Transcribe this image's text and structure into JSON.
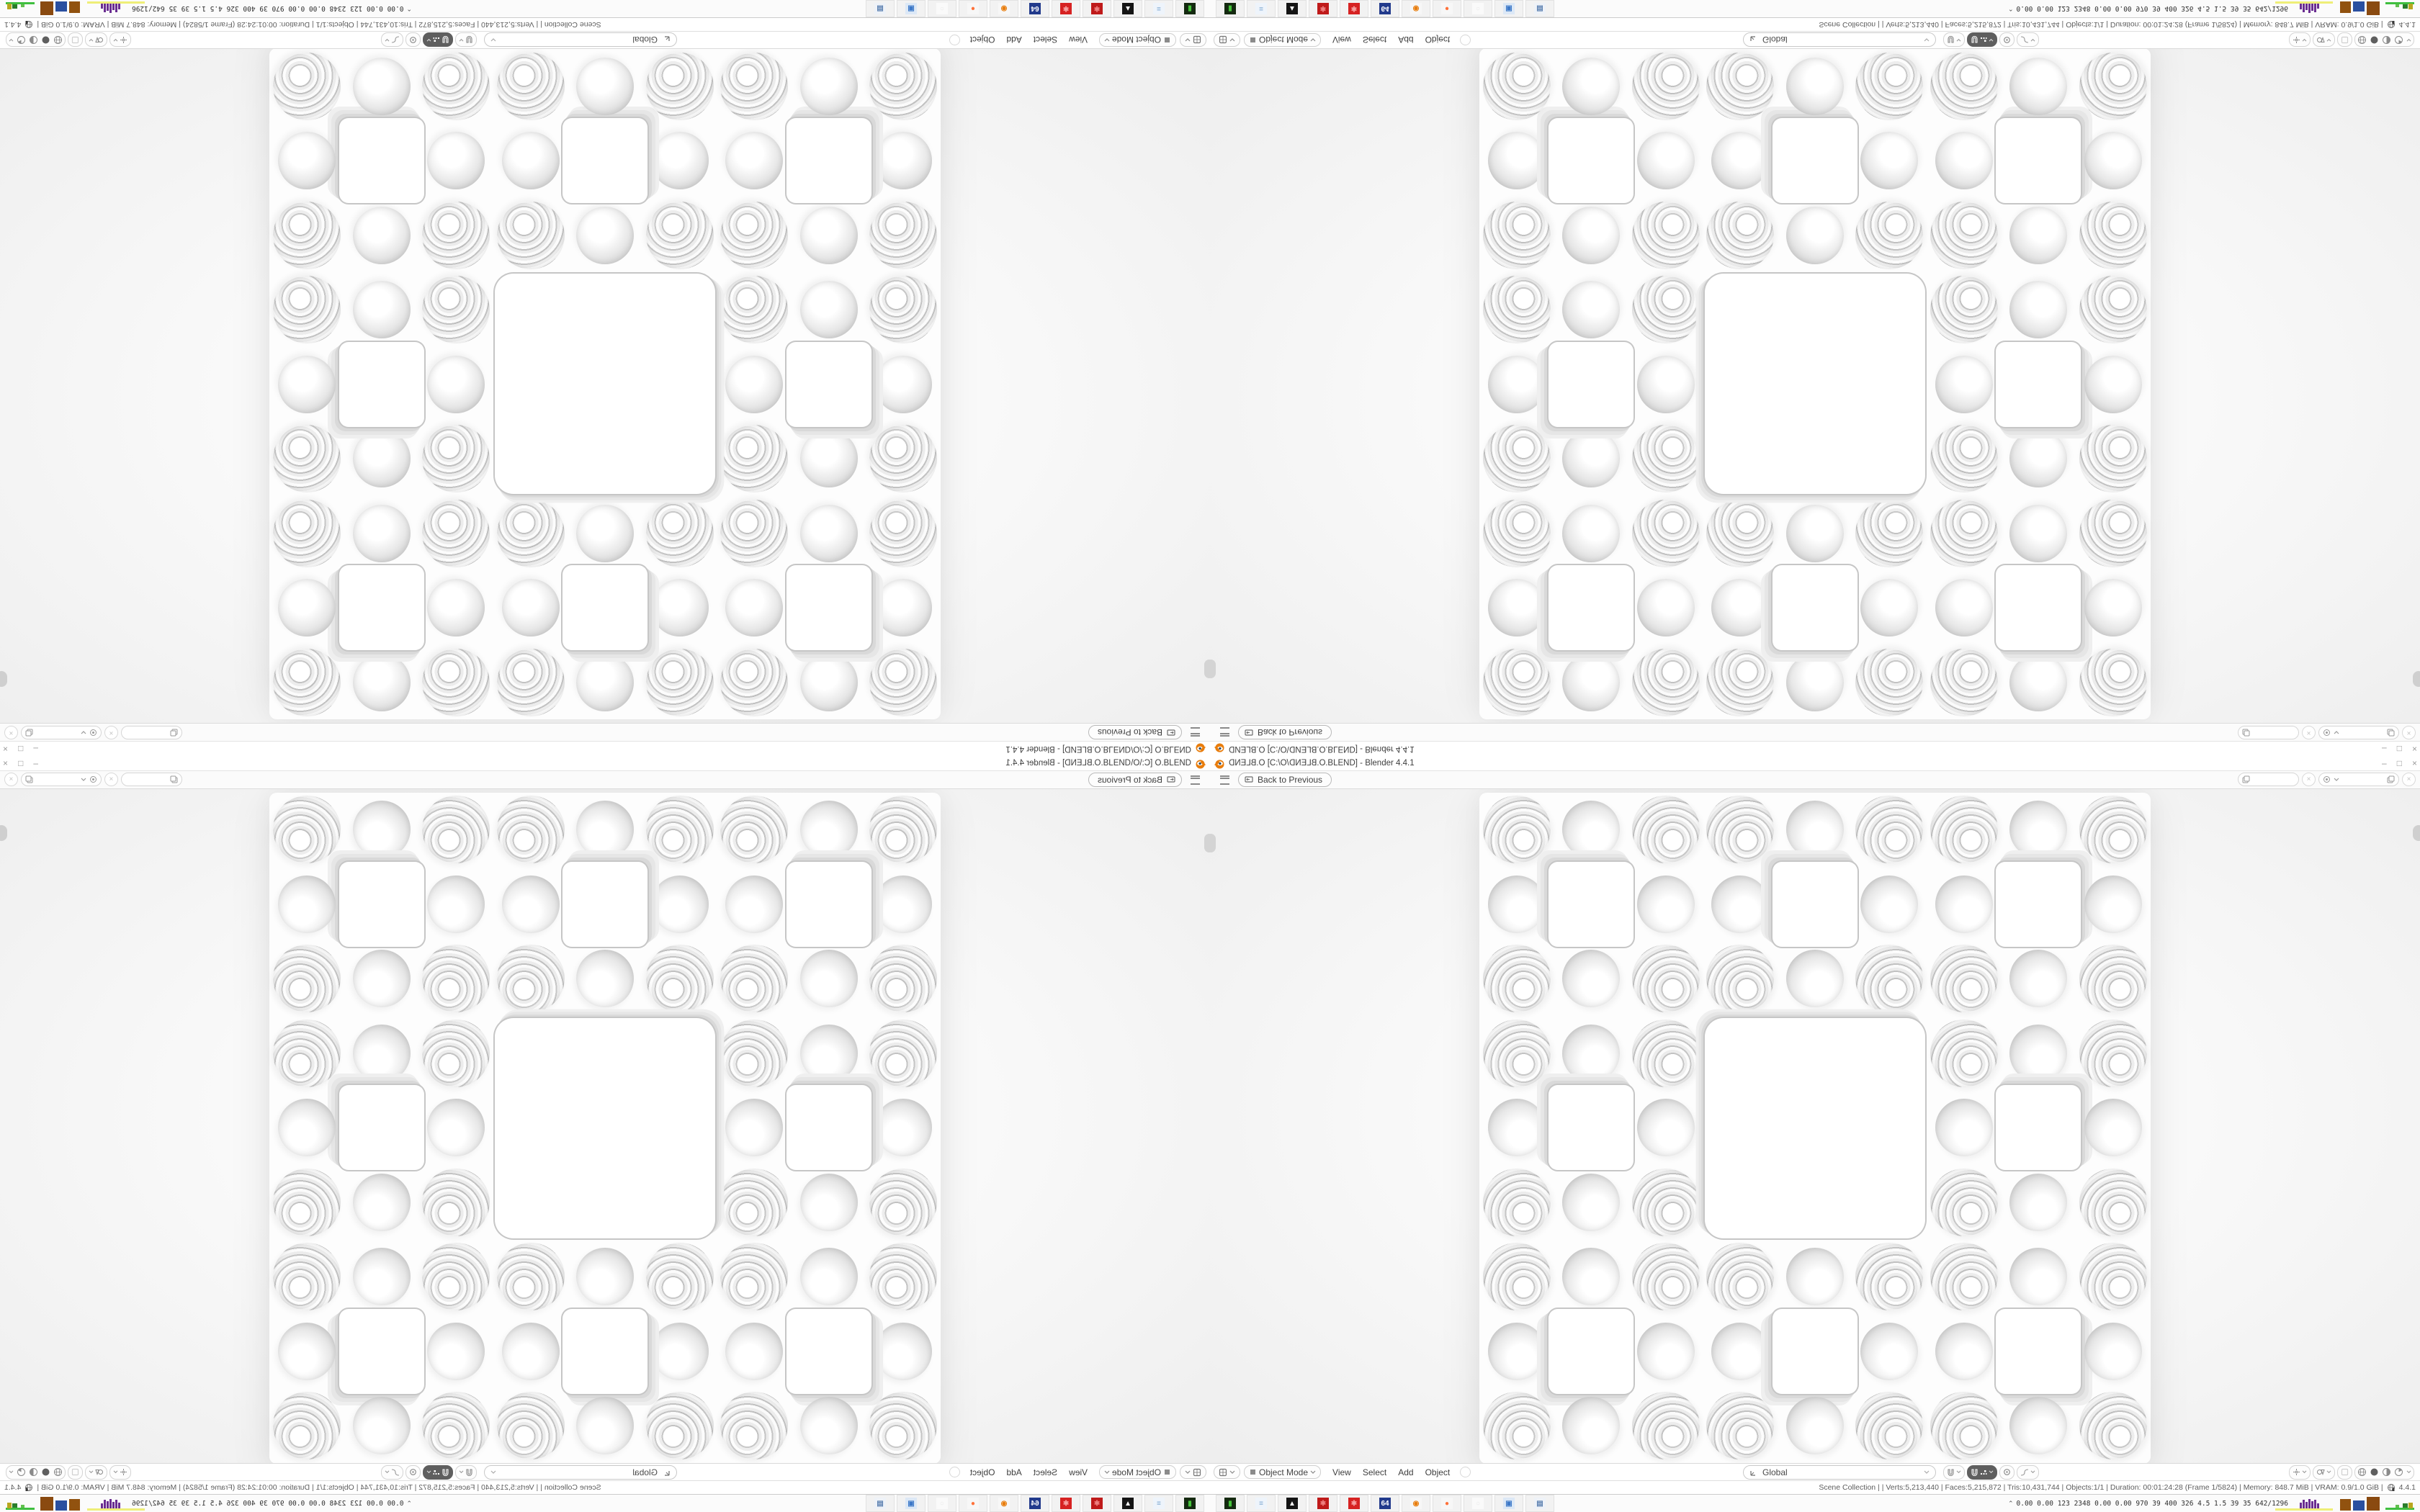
{
  "window": {
    "file_mirrored": "O.BLEND",
    "path_prefix": " [C:\\O\\",
    "path_suffix": ".BLEND] - Blender 4.4.1",
    "controls": {
      "minimize": "–",
      "restore": "□",
      "close": "×"
    }
  },
  "topbar": {
    "back_label": "Back to Previous",
    "scene_field_value": "",
    "view_layer_field_value": "",
    "close_scene_label": "×",
    "close_layer_label": "×"
  },
  "viewport_header": {
    "mode_label": "Object Mode",
    "menus": [
      "View",
      "Select",
      "Add",
      "Object"
    ],
    "orientation_label": "Global"
  },
  "status_bar": {
    "text": "Scene Collection |      | Verts:5,213,440 | Faces:5,215,872 | Tris:10,431,744 | Objects:1/1 | Duration: 00:01:24:28 (Frame 1/5824) | Memory: 848.7 MiB | VRAM: 0.9/1.0 GiB |",
    "version": "4.4.1"
  },
  "taskbar": {
    "tray_chevron": "⌃",
    "stats": "0.00 0.00  123  2348 0.00 0.00  970   39   400  326  4.5   1.5   39    35  642/1296",
    "icons": [
      {
        "name": "green-terminal-icon",
        "bg": "#142a10",
        "fg": "#45c43a",
        "glyph": "▮"
      },
      {
        "name": "notepad-icon",
        "bg": "#eef4fb",
        "fg": "#7fa8d0",
        "glyph": "≡"
      },
      {
        "name": "photo-app-icon",
        "bg": "#141414",
        "fg": "#ffffff",
        "glyph": "▲"
      },
      {
        "name": "red-gear-icon",
        "bg": "#bf1a1a",
        "fg": "#ef8080",
        "glyph": "✱"
      },
      {
        "name": "red-gear2-icon",
        "bg": "#d62222",
        "fg": "#f6a0a0",
        "glyph": "✱"
      },
      {
        "name": "floppy-64-icon",
        "bg": "#223a8c",
        "fg": "#ffffff",
        "glyph": "64"
      },
      {
        "name": "blender-app-icon",
        "bg": "#f7f7f7",
        "fg": "#e87d0d",
        "glyph": "◉"
      },
      {
        "name": "firefox-icon",
        "bg": "#f7f7f7",
        "fg": "#ff7139",
        "glyph": "●"
      },
      {
        "name": "ghost-app-icon",
        "bg": "#fafafa",
        "fg": "#e8e8e8",
        "glyph": "○"
      },
      {
        "name": "my-computer-icon",
        "bg": "#dce8f6",
        "fg": "#3c78c8",
        "glyph": "▣"
      },
      {
        "name": "calculator-icon",
        "bg": "#eef2f8",
        "fg": "#5c80b0",
        "glyph": "▤"
      }
    ],
    "graph_bar_heights": [
      8,
      12,
      9,
      13,
      10,
      12,
      7
    ],
    "block_widths": [
      15,
      16,
      18
    ],
    "block_heights": [
      16,
      14,
      19
    ],
    "block_colors": [
      "#91520f",
      "#2a4fa0",
      "#8a4a10"
    ]
  },
  "fractal": {
    "grid": 9,
    "cell": 103.5,
    "size": 932,
    "big_hole_size": 306,
    "square_hole_size": 118,
    "sphere_smooth_size": 80,
    "sphere_ring_size": 94,
    "ring_colors": [
      "#c6c6c6",
      "#d9d9d9",
      "#e6e6e6",
      "#efefef"
    ]
  },
  "colors": {
    "accent_orange": "#e87d0d",
    "bar_bg": "#ffffff",
    "viewport_bg": "#f0f0f0",
    "active_button": "#5f5f5f"
  }
}
